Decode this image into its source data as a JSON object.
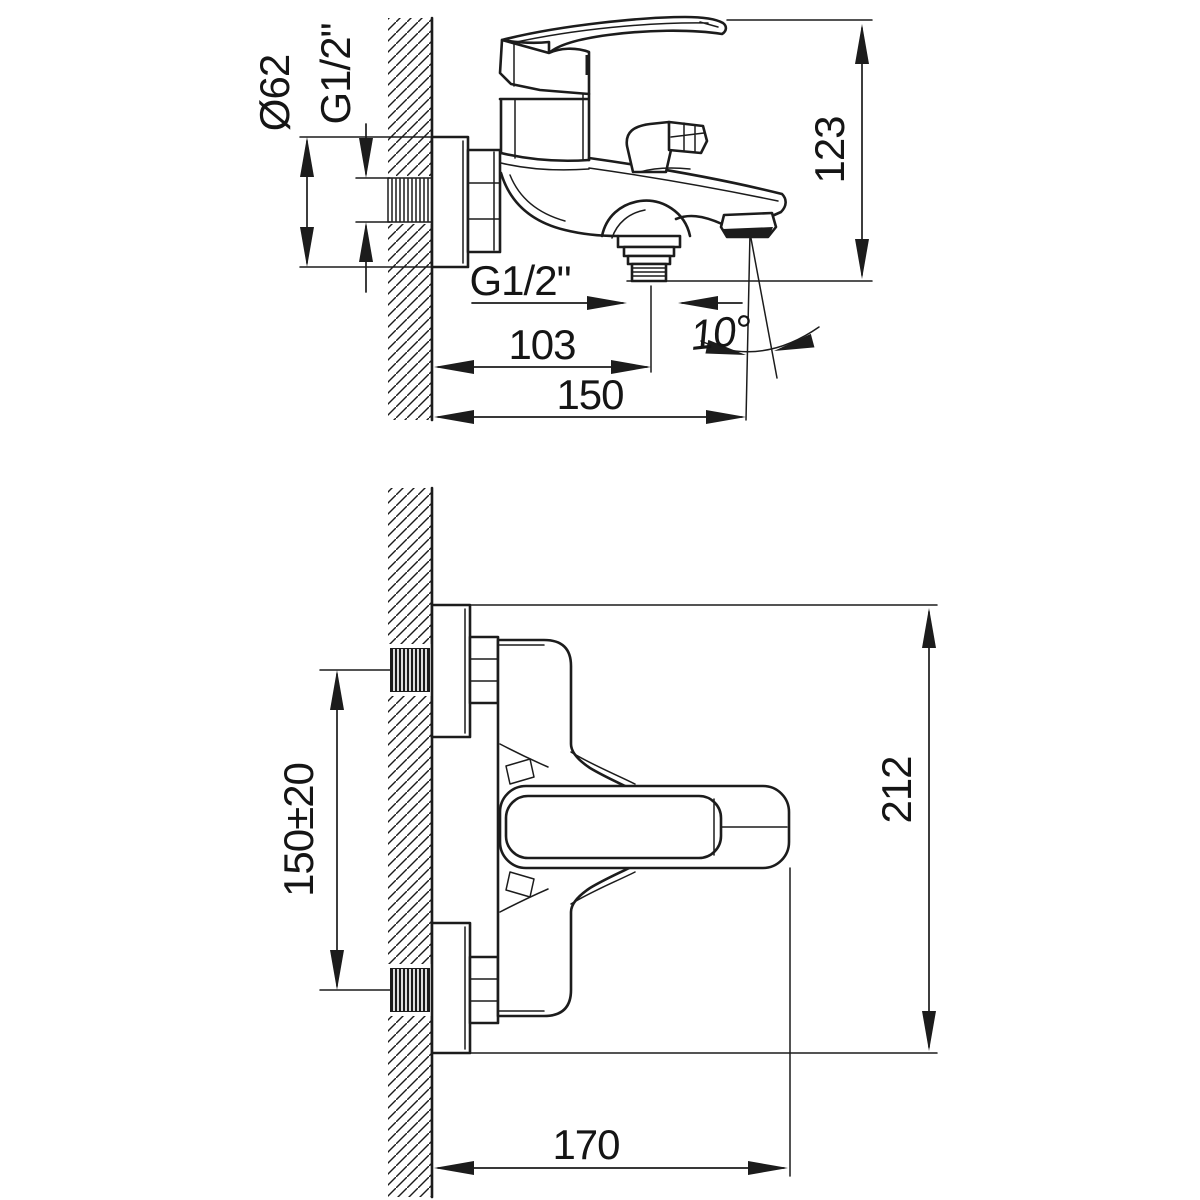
{
  "page": {
    "background": "#ffffff",
    "line_color": "#1c1c1c"
  },
  "drawing": {
    "type": "technical-dimension-drawing",
    "subject": "wall-mounted bath mixer faucet, two projection views with dimensions in mm",
    "side_view": {
      "name": "side view (wall section left)",
      "labels": {
        "plate_diameter": "Ø62",
        "wall_thread": "G1/2\"",
        "overall_height": "123",
        "shower_outlet_thread": "G1/2\"",
        "outlet_offset": "103",
        "spout_reach": "150",
        "spray_angle": "10°"
      }
    },
    "front_view": {
      "name": "front view (wall section left)",
      "labels": {
        "inlet_center_distance": "150±20",
        "overall_height": "212",
        "overall_width": "170"
      }
    }
  }
}
